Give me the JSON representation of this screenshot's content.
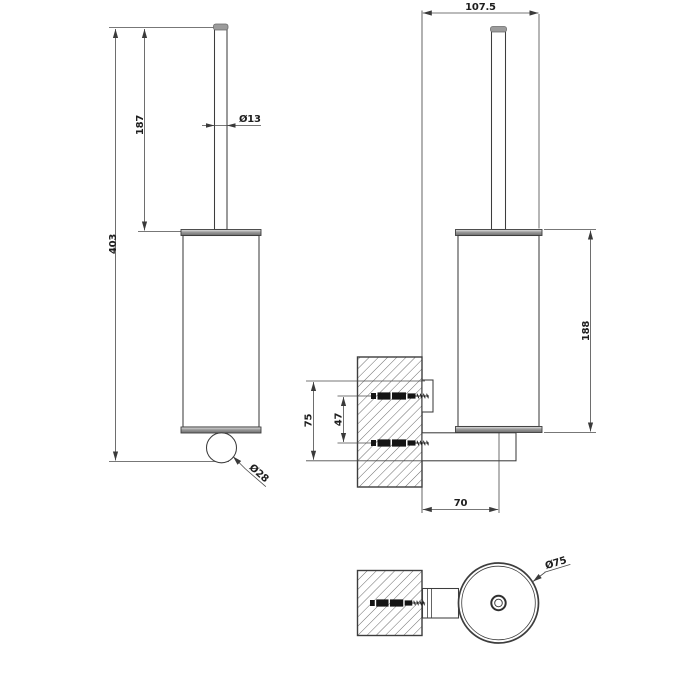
{
  "drawing": {
    "kind": "technical-dimension-drawing",
    "subject": "wall-mounted brush holder, three orthographic views",
    "colors": {
      "background": "#ffffff",
      "line": "#3d3d3d",
      "dimension_line": "#4a4a4a",
      "text": "#1e1e1e",
      "rim_fill": "#9a9a9a",
      "screw_fill": "#141414"
    }
  },
  "labels": {
    "total_height": "403",
    "handle_length": "187",
    "handle_diameter": "Ø13",
    "knob_diameter": "Ø28",
    "overall_depth": "107.5",
    "body_height": "188",
    "bracket_span": "75",
    "hole_spacing": "47",
    "wall_to_axis": "70",
    "body_diameter": "Ø75"
  }
}
